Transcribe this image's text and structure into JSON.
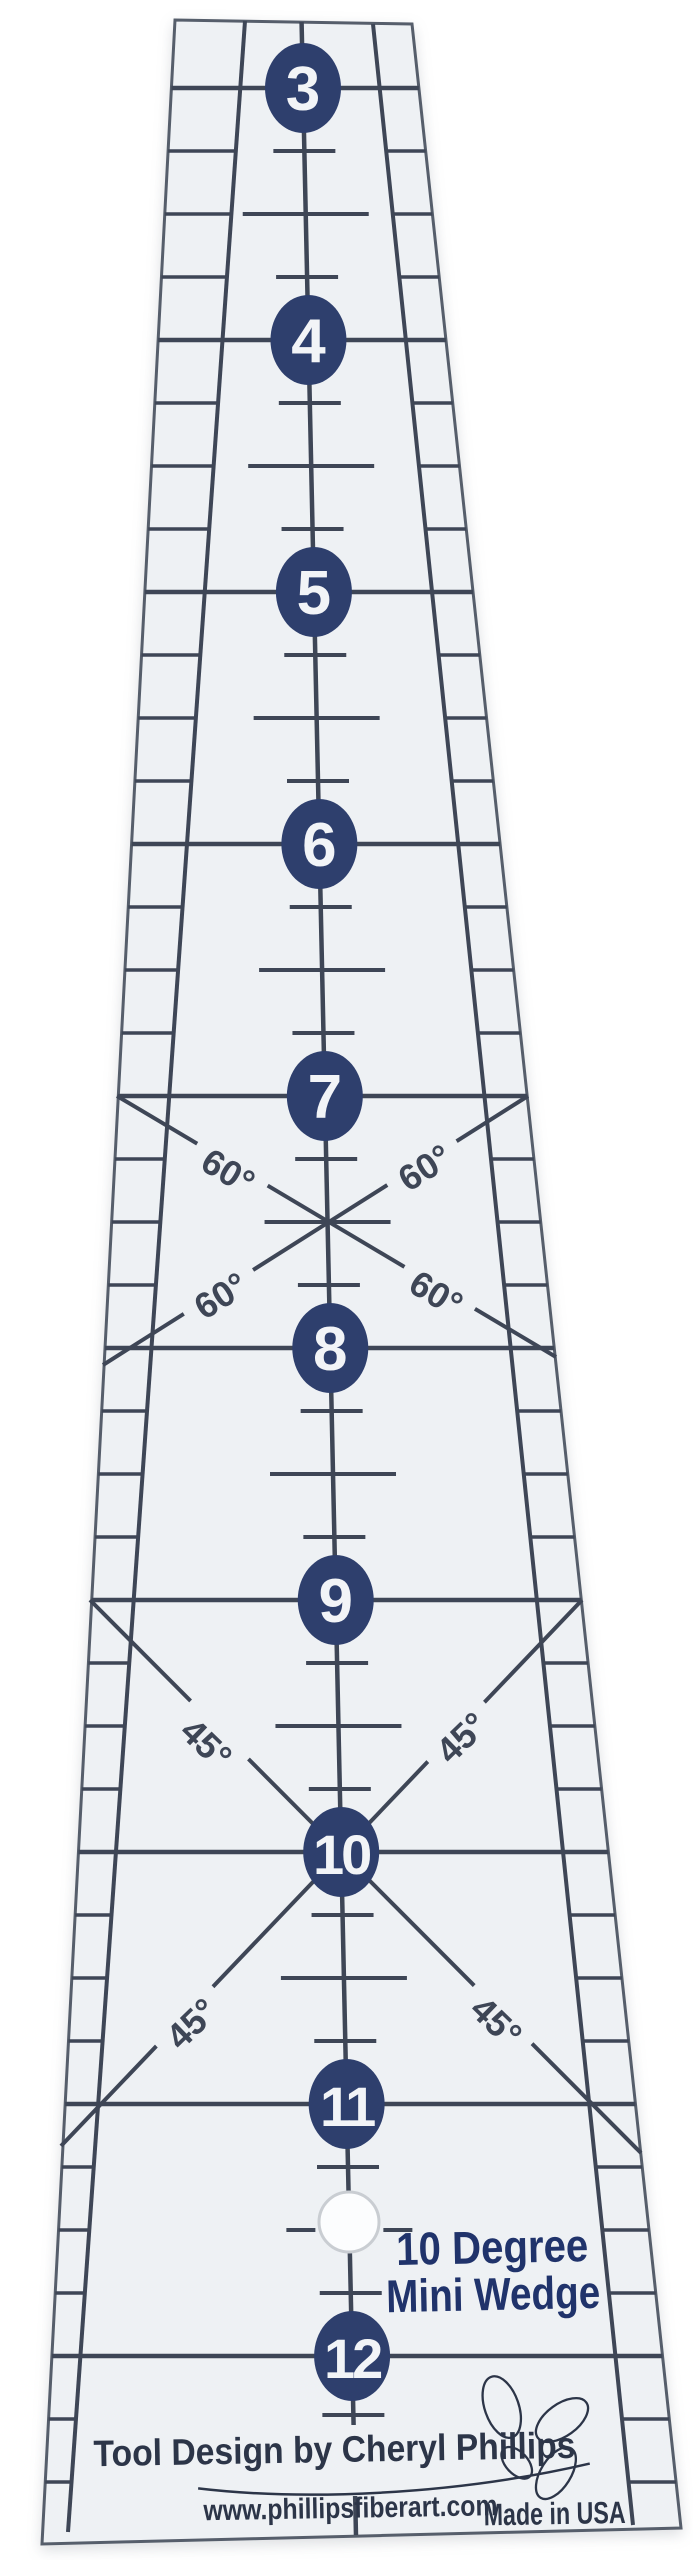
{
  "title": "10 Degree Mini Wedge ruler",
  "product": {
    "line1": "10 Degree",
    "line2": "Mini Wedge"
  },
  "scale": {
    "numbers": [
      "3",
      "4",
      "5",
      "6",
      "7",
      "8",
      "9",
      "10",
      "11",
      "12"
    ]
  },
  "angles": {
    "sixty": "60°",
    "forty_five": "45°"
  },
  "footer": {
    "designer": "Tool Design by Cheryl Phillips",
    "website": "www.phillipsfiberart.com",
    "origin": "Made in USA"
  },
  "colors": {
    "background": "#ffffff",
    "body": "#eef1f4",
    "line": "#3e4656",
    "edge": "#565e6b",
    "circle": "#2e3f6d",
    "circle_text": "#f2f4f7",
    "product_text": "#20336b",
    "footer_text": "#2c3548",
    "hole_stroke": "#c9cdd2",
    "hole_fill": "#fcfdfe"
  }
}
